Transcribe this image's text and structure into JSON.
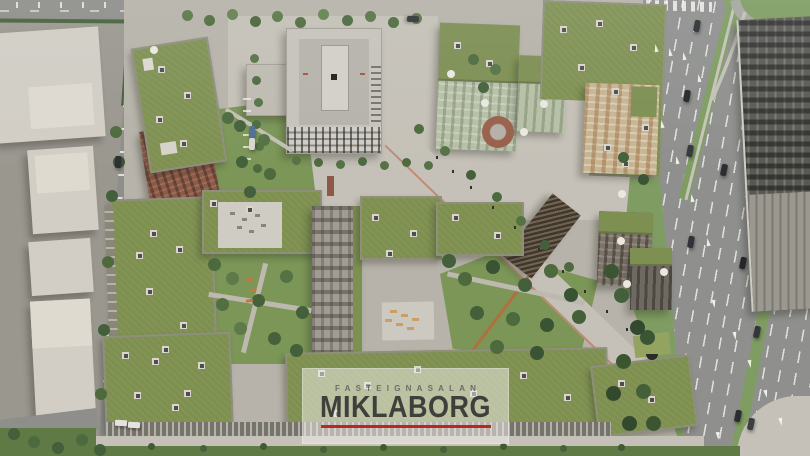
{
  "watermark": {
    "agency_label": "FASTEIGNASALAN",
    "brand": "MIKLABORG"
  },
  "palette": {
    "ground": "#a8a49c",
    "lot": "#9a978f",
    "asphalt": "#8e8e8a",
    "road": "#8f908e",
    "pavement": "#b7b3a9",
    "pavement_light": "#c5c1b7",
    "warehouse": "#d2cec5",
    "warehouse_light": "#dedacf",
    "hedge": "#44603a",
    "green_roof": "#7c8f4e",
    "green_roof_light": "#93a45e",
    "lawn": "#7a9754",
    "lawn_dark": "#5e7a42",
    "grass_verge": "#7e9e5f",
    "brick": "#8e5a45",
    "sage": "#b6c0a4",
    "beige": "#c8b590",
    "tower": "#c6c3bb",
    "tower_roof": "#b6b3ab",
    "dark_building": "#595954",
    "facade_dark": "#76736a",
    "skylight_frame": "#d9d6cc",
    "skylight": "#4f4e48",
    "dome": "#eae8e1",
    "bench_orange": "#c07a3c",
    "wm_bg": "rgba(241,240,235,0.52)",
    "wm_sub": "#6e6d66",
    "wm_brand": "#403f3b",
    "wm_line": "#c22424"
  }
}
